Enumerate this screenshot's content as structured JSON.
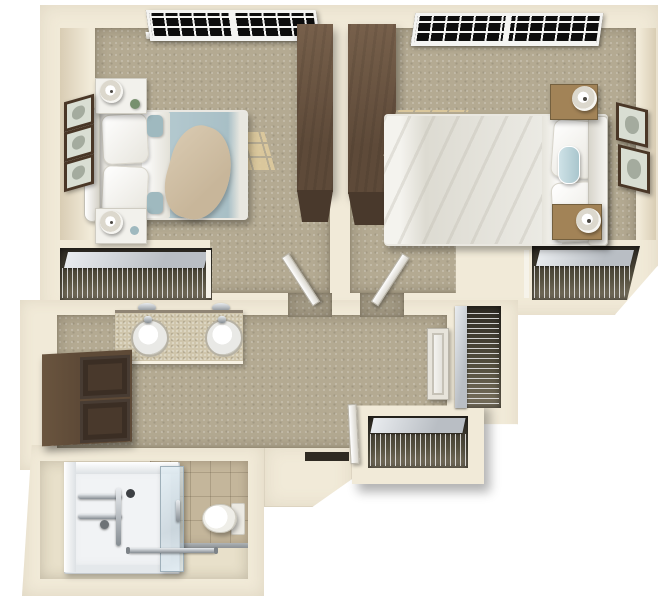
{
  "meta": {
    "description": "3D top-down rendered floor plan of a two-bedroom companion suite with shared vanity hallway and accessible bathroom",
    "background": "#ffffff"
  },
  "palette": {
    "wall": "#f1ead8",
    "carpet": "#b4aa92",
    "sun": "#dfcb9e",
    "wood-top": "#77604b",
    "wood-side": "#5e4a39",
    "wood-front": "#49392c",
    "nightstand-wood": "#a28357",
    "bed-blue": "#b7ccd2",
    "bed-cream": "#ecebe5",
    "linen": "#f6f5f1",
    "throw": "#d9cab1",
    "closet-dark": "#55503f",
    "shelf": "#b9bec4",
    "tile": "#c4b69b",
    "bath-floor": "#e8e0ca",
    "shower": "#f1f3f5",
    "glass": "#c6d6e0",
    "chrome": "#9aa1a7",
    "frame": "#4a3727",
    "art": "#d9ded3",
    "pane": "#0d0d0d",
    "win-frame": "#f4f4f2",
    "counter": "#cfc5ab",
    "teal-accent": "#9fb9bf",
    "toilet-white": "#fbfbf9"
  },
  "scene": {
    "type": "3d-floor-plan",
    "rooms": [
      {
        "id": "bedroom-left",
        "features": [
          "double-window",
          "bed-with-teal-bedding",
          "white-nightstand-top",
          "white-nightstand-bottom",
          "two-table-lamps",
          "three-wall-frames",
          "wardrobe",
          "wire-shelf-closet",
          "open-door",
          "sunlight-patches"
        ]
      },
      {
        "id": "bedroom-right",
        "features": [
          "double-window",
          "bed-with-white-bedding",
          "wood-nightstand-top",
          "wood-nightstand-bottom",
          "two-table-lamps",
          "two-wall-frames",
          "wardrobe",
          "wire-shelf-closet",
          "open-door",
          "sunlight-patches"
        ]
      },
      {
        "id": "hallway",
        "features": [
          "double-sink-vanity",
          "two-wall-sconces",
          "storage-cabinet",
          "entry-door",
          "tall-wire-closet",
          "lower-wire-closet",
          "bathroom-door"
        ]
      },
      {
        "id": "bathroom",
        "features": [
          "roll-in-shower",
          "grab-bars",
          "glass-panel",
          "toilet",
          "tile-floor",
          "towel-bar"
        ]
      }
    ]
  }
}
